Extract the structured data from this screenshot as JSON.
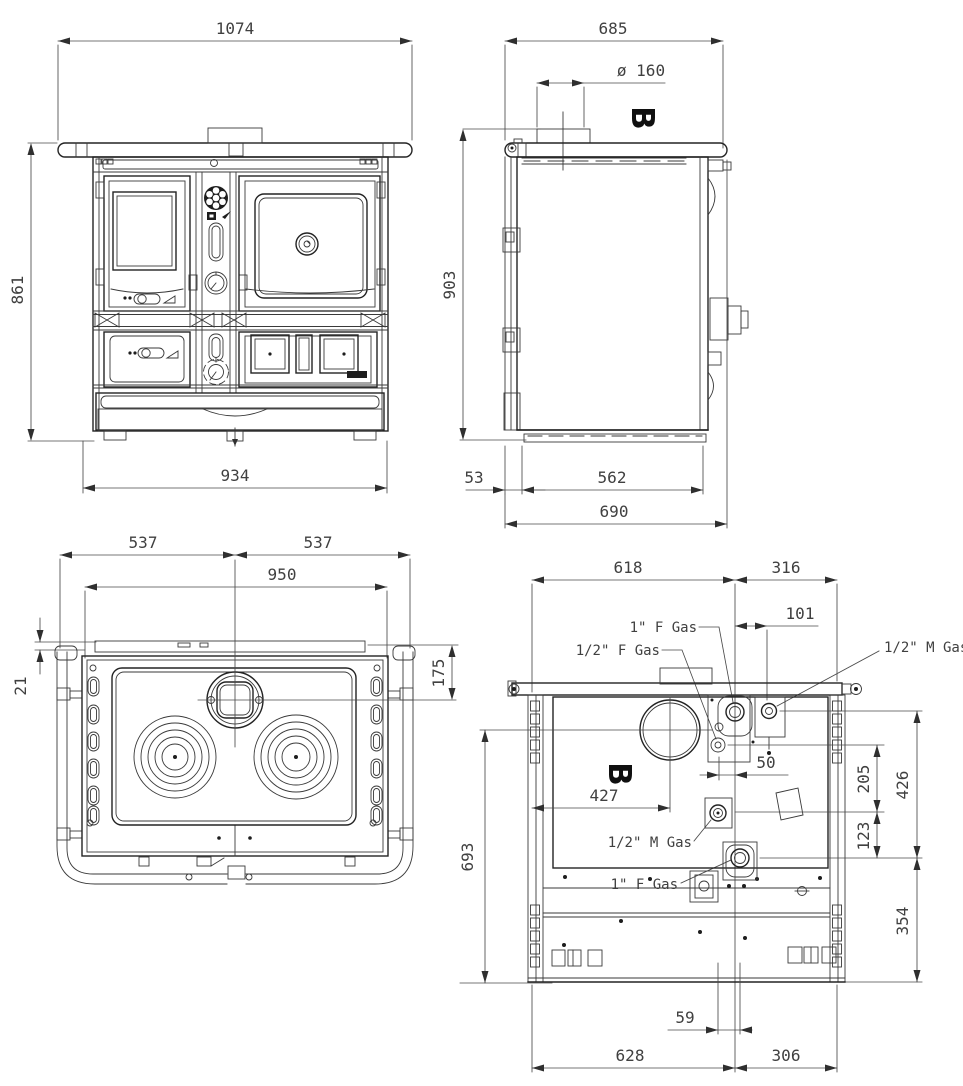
{
  "views": {
    "front": {
      "dims": {
        "overall_width": "1074",
        "overall_height": "861",
        "body_width": "934"
      }
    },
    "side": {
      "view_label": "B",
      "dims": {
        "overall_depth": "685",
        "flue_diameter": "ø  160",
        "overall_height": "903",
        "base_front_offset": "53",
        "base_depth": "562",
        "total_depth": "690"
      }
    },
    "top": {
      "dims": {
        "half_width_left": "537",
        "half_width_right": "537",
        "worktop_width": "950",
        "flue_center_offset": "175",
        "back_edge_offset": "21"
      }
    },
    "rear": {
      "view_label": "B",
      "dims": {
        "width_left": "618",
        "width_right": "316",
        "gas_right_offset": "101",
        "flue_center_x": "427",
        "gas_pair_spacing": "50",
        "gas_mid_drop": "205",
        "gas_bottom_drop": "123",
        "gas_top_drop": "426",
        "flue_height": "693",
        "bottom_section": "354",
        "gas_bottom_offset": "59",
        "bottom_width_left": "628",
        "bottom_width_right": "306"
      },
      "gas_labels": {
        "top_1f": "1\" F Gas",
        "top_12f": "1/2\" F Gas",
        "right_12m": "1/2\" M Gas",
        "mid_12m": "1/2\" M Gas",
        "bottom_1f": "1\" F Gas"
      }
    }
  }
}
